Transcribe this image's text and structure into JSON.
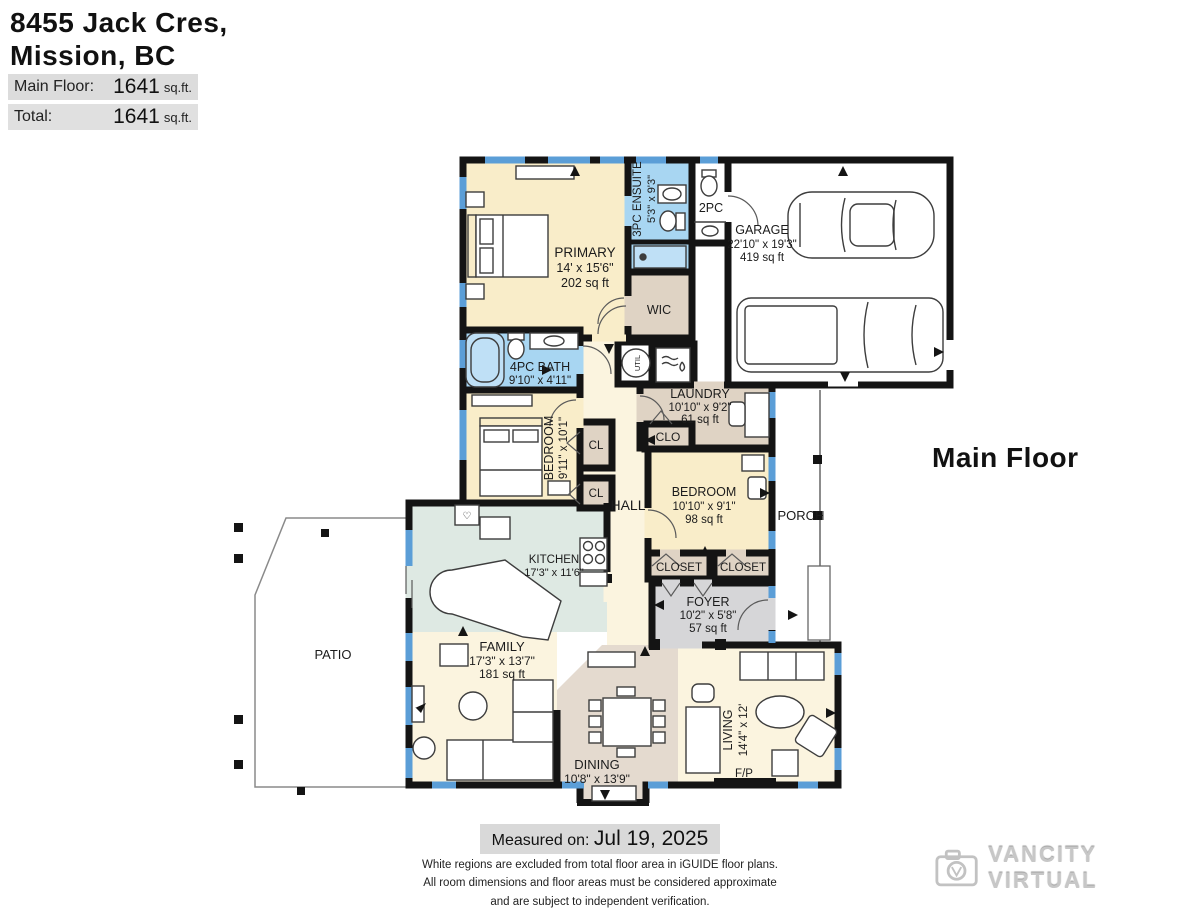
{
  "header": {
    "address_line1": "8455 Jack Cres,",
    "address_line2": "Mission, BC",
    "areas": [
      {
        "label": "Main Floor:",
        "value": "1641",
        "unit": "sq.ft."
      },
      {
        "label": "Total:",
        "value": "1641",
        "unit": "sq.ft."
      }
    ]
  },
  "floor_label": "Main Floor",
  "rooms": {
    "primary": {
      "name": "PRIMARY",
      "dims": "14' x 15'6\"",
      "area": "202 sq ft"
    },
    "ensuite": {
      "name": "3PC ENSUITE",
      "dims": "5'3\" x 9'3\""
    },
    "powder": {
      "name": "2PC"
    },
    "garage": {
      "name": "GARAGE",
      "dims": "22'10\" x 19'3\"",
      "area": "419 sq ft"
    },
    "wic": {
      "name": "WIC"
    },
    "bath4pc": {
      "name": "4PC BATH",
      "dims": "9'10\" x 4'11\""
    },
    "bedroom1": {
      "name": "BEDROOM",
      "dims": "9'11\" x 10'1\""
    },
    "cl1": {
      "name": "CL"
    },
    "cl2": {
      "name": "CL"
    },
    "hall": {
      "name": "HALL"
    },
    "util": {
      "name": "UTIL"
    },
    "laundry": {
      "name": "LAUNDRY",
      "dims": "10'10\" x 9'2\"",
      "area": "61 sq ft"
    },
    "clo": {
      "name": "CLO"
    },
    "bedroom2": {
      "name": "BEDROOM",
      "dims": "10'10\" x 9'1\"",
      "area": "98 sq ft"
    },
    "porch": {
      "name": "PORCH"
    },
    "closet1": {
      "name": "CLOSET"
    },
    "closet2": {
      "name": "CLOSET"
    },
    "foyer": {
      "name": "FOYER",
      "dims": "10'2\" x 5'8\"",
      "area": "57 sq ft"
    },
    "kitchen": {
      "name": "KITCHEN",
      "dims": "17'3\" x 11'6\""
    },
    "family": {
      "name": "FAMILY",
      "dims": "17'3\" x 13'7\"",
      "area": "181 sq ft"
    },
    "dining": {
      "name": "DINING",
      "dims": "10'8\" x 13'9\""
    },
    "living": {
      "name": "LIVING",
      "dims": "14'4\" x 12'"
    },
    "fireplace": {
      "name": "F/P"
    },
    "patio": {
      "name": "PATIO"
    }
  },
  "footer": {
    "measured_label": "Measured on:",
    "measured_date": "Jul 19, 2025",
    "disclaimer": [
      "White regions are excluded from total floor area in iGUIDE floor plans.",
      "All room dimensions and floor areas must be considered approximate",
      "and are subject to independent verification."
    ]
  },
  "watermark": {
    "text": "VANCITY VIRTUAL"
  },
  "colors": {
    "wall": "#141414",
    "window": "#5b9ed7",
    "bath_blue": "#a8d6f2",
    "bedroom_cream": "#f9edc9",
    "living_cream": "#fbf4df",
    "storage_tan": "#dfd3c4",
    "dining_tan": "#e4dacf",
    "kitchen_teal": "#dee9e3",
    "foyer_gray": "#d6d6d8"
  }
}
